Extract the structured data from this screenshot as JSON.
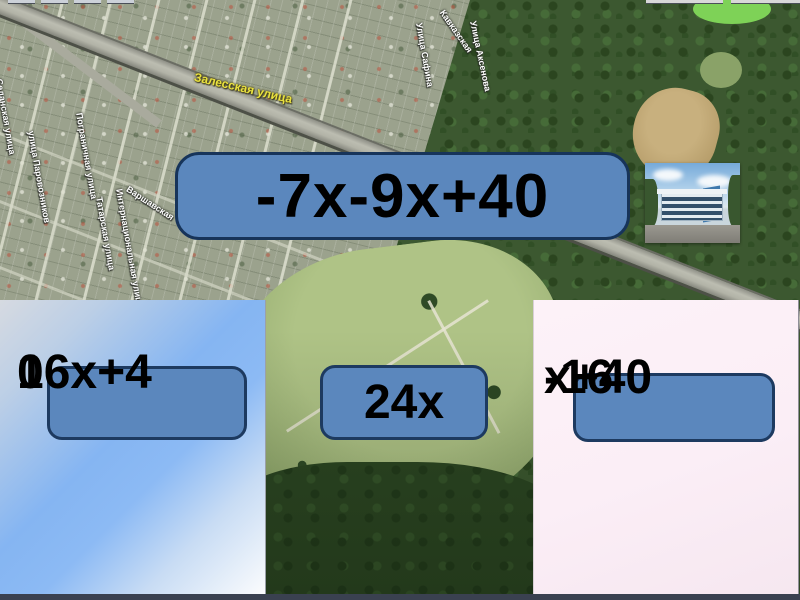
{
  "question": {
    "label": "-7x-9x+40"
  },
  "answers": [
    {
      "label": "16x+40",
      "lines": [
        "16x+4",
        "0"
      ]
    },
    {
      "label": "24x",
      "lines": [
        "24x",
        ""
      ]
    },
    {
      "label": "-16 x+40",
      "lines": [
        "-16",
        "x+40"
      ]
    }
  ],
  "map": {
    "street_labels": [
      {
        "text": "Залесская улица"
      },
      {
        "text": "Седанская улица"
      },
      {
        "text": "улица Паровозников"
      },
      {
        "text": "Пограничная улица"
      },
      {
        "text": "Татарская улица"
      },
      {
        "text": "Интернациональная улица"
      },
      {
        "text": "Варшавская"
      },
      {
        "text": "Улица Сафина"
      },
      {
        "text": "Кавказская"
      },
      {
        "text": "Улица Аксенова"
      }
    ]
  },
  "colors": {
    "button_fill": "#5B87BD",
    "button_border": "#17345A",
    "button_text": "#000000",
    "left_panel_blue": "#85B5F2",
    "right_panel_pink": "#FBEFF7",
    "street_label_yellow": "#E9E13F",
    "bottom_bar": "#3A4150"
  }
}
